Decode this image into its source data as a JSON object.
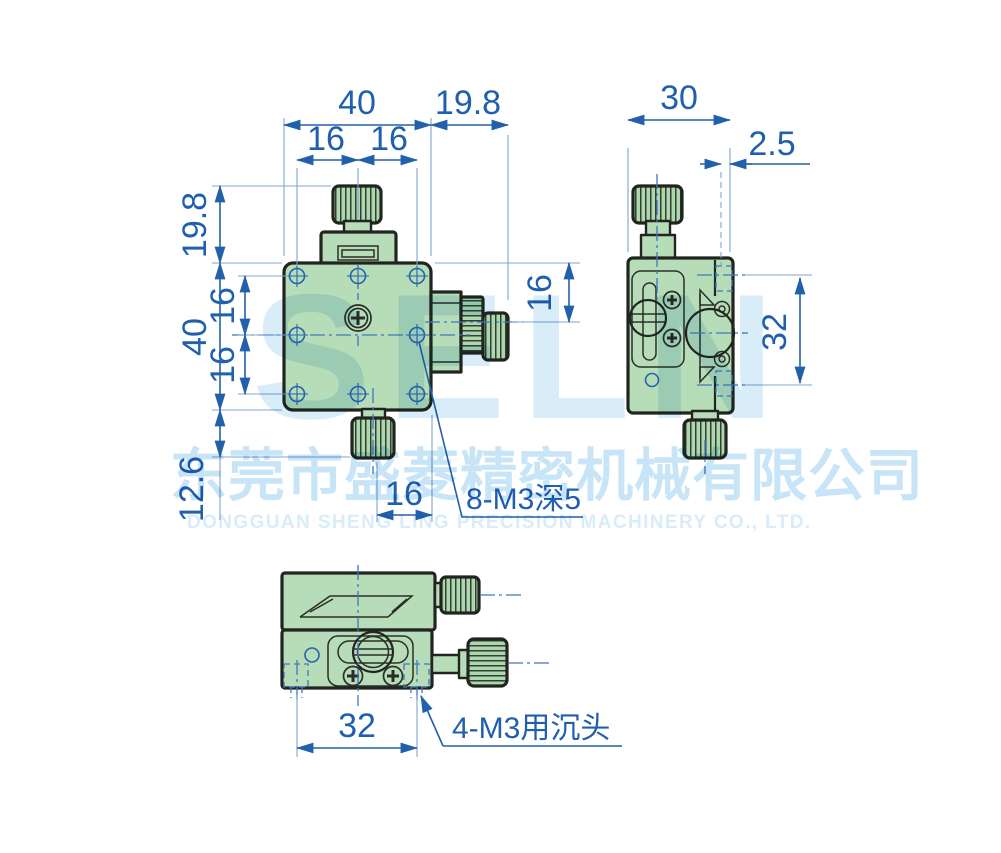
{
  "drawing": {
    "front_view": {
      "dim_width": "40",
      "dim_offset_right": "19.8",
      "dim_hole_left": "16",
      "dim_hole_right": "16",
      "dim_knob_height": "19.8",
      "dim_height": "40",
      "dim_row_upper": "16",
      "dim_row_lower": "16",
      "dim_base_knob": "12.6",
      "dim_bottom_offset": "16",
      "dim_axis_offset": "16",
      "callout_threads": "8-M3深5"
    },
    "side_view": {
      "dim_width": "30",
      "dim_plate_offset": "2.5",
      "dim_hole_span": "32"
    },
    "bottom_view": {
      "dim_hole_span": "32",
      "callout_counterbore": "4-M3用沉头"
    }
  },
  "watermark": {
    "logo": "SELN",
    "company_cn": "东莞市盛菱精密机械有限公司",
    "company_en": "DONGGUAN SHENG LING PRECISION MACHINERY CO., LTD."
  },
  "colors": {
    "dimension_blue": "#1f5fae",
    "body_green": "#b6dcb8",
    "knurl_green": "#aed7b0",
    "outline_dark": "#22251f",
    "watermark_blue": "#cfe9f7",
    "background": "#ffffff"
  }
}
